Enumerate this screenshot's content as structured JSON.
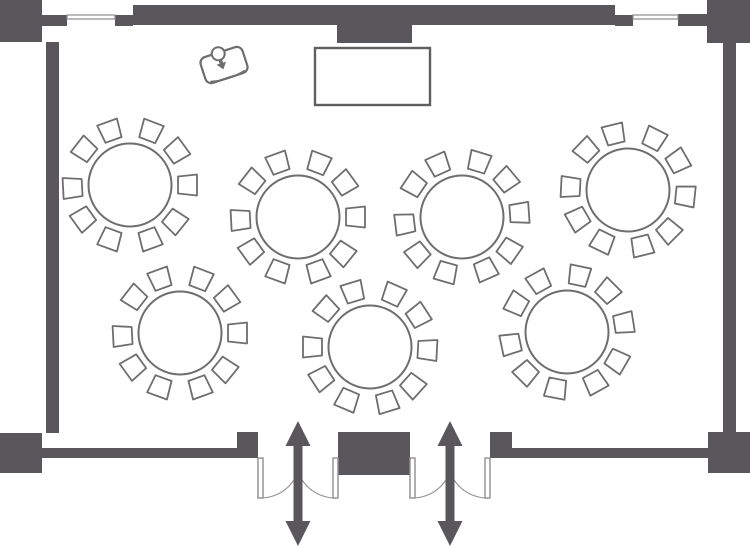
{
  "canvas": {
    "width": 750,
    "height": 547
  },
  "colors": {
    "background": "#ffffff",
    "wall": "#5a575c",
    "furniture_outline": "#6e6e6e",
    "furniture_fill": "#ffffff",
    "window_frame": "#8c8c8c",
    "door_leaf_stroke": "#8f8f8f",
    "door_arc": "#9a9a9a",
    "arrow": "#5a575c"
  },
  "room": {
    "walls": [
      {
        "name": "corner-top-left",
        "x": 0,
        "y": 0,
        "w": 42,
        "h": 42
      },
      {
        "name": "wall-top-left-tab",
        "x": 42,
        "y": 15,
        "w": 25,
        "h": 11
      },
      {
        "name": "wall-top-window-stub-left",
        "x": 115,
        "y": 15,
        "w": 18,
        "h": 11
      },
      {
        "name": "wall-top-main",
        "x": 133,
        "y": 5,
        "w": 482,
        "h": 20
      },
      {
        "name": "wall-top-pillar",
        "x": 337,
        "y": 25,
        "w": 75,
        "h": 18
      },
      {
        "name": "wall-top-window-stub-right",
        "x": 615,
        "y": 15,
        "w": 18,
        "h": 11
      },
      {
        "name": "wall-top-right-tab",
        "x": 678,
        "y": 14,
        "w": 29,
        "h": 12
      },
      {
        "name": "corner-top-right",
        "x": 707,
        "y": 0,
        "w": 43,
        "h": 43
      },
      {
        "name": "wall-left",
        "x": 46,
        "y": 42,
        "w": 13,
        "h": 391
      },
      {
        "name": "wall-right",
        "x": 723,
        "y": 43,
        "w": 13,
        "h": 389
      },
      {
        "name": "corner-bottom-left",
        "x": 0,
        "y": 433,
        "w": 42,
        "h": 40
      },
      {
        "name": "wall-bottom-left",
        "x": 42,
        "y": 448,
        "w": 195,
        "h": 10
      },
      {
        "name": "door-jamb-pillar-left",
        "x": 237,
        "y": 432,
        "w": 21,
        "h": 26
      },
      {
        "name": "wall-bottom-center-block",
        "x": 338,
        "y": 432,
        "w": 72,
        "h": 43
      },
      {
        "name": "door-jamb-pillar-right",
        "x": 490,
        "y": 432,
        "w": 22,
        "h": 26
      },
      {
        "name": "wall-bottom-right",
        "x": 512,
        "y": 448,
        "w": 196,
        "h": 10
      },
      {
        "name": "corner-bottom-right",
        "x": 708,
        "y": 432,
        "w": 42,
        "h": 41
      }
    ],
    "windows": [
      {
        "name": "window-top-left",
        "x": 67,
        "y": 15,
        "w": 48,
        "h": 4
      },
      {
        "name": "window-top-right",
        "x": 633,
        "y": 15,
        "w": 45,
        "h": 4
      }
    ]
  },
  "stage": {
    "name": "head-table",
    "x": 315,
    "y": 48,
    "w": 115,
    "h": 57
  },
  "lectern": {
    "name": "lectern",
    "cx": 224,
    "cy": 65,
    "rotation": -18,
    "body_w": 44,
    "body_h": 27,
    "head_r": 6.5
  },
  "tables": {
    "radius": 41.5,
    "chair": {
      "back_w": 21,
      "front_w": 17,
      "depth": 19,
      "ring_r": 57.5,
      "count": 10,
      "step_deg": 36,
      "jitter_deg": [
        0,
        3,
        -2,
        2,
        0,
        -3,
        2,
        -2,
        3,
        0
      ]
    },
    "items": [
      {
        "id": "banquet-table-1",
        "cx": 130,
        "cy": 185,
        "phase_deg": 0
      },
      {
        "id": "banquet-table-2",
        "cx": 298,
        "cy": 217,
        "phase_deg": 0
      },
      {
        "id": "banquet-table-3",
        "cx": 462,
        "cy": 217,
        "phase_deg": -4
      },
      {
        "id": "banquet-table-4",
        "cx": 628,
        "cy": 190,
        "phase_deg": 6
      },
      {
        "id": "banquet-table-5",
        "cx": 180,
        "cy": 333,
        "phase_deg": 0
      },
      {
        "id": "banquet-table-6",
        "cx": 370,
        "cy": 347,
        "phase_deg": 3
      },
      {
        "id": "banquet-table-7",
        "cx": 567,
        "cy": 332,
        "phase_deg": -9
      }
    ]
  },
  "doors": {
    "leaf_len": 40,
    "leaf_w": 5,
    "wall_y": 458,
    "items": [
      {
        "id": "double-door-left",
        "x1": 258,
        "x2": 338
      },
      {
        "id": "double-door-right",
        "x1": 410,
        "x2": 490
      }
    ]
  },
  "arrows": {
    "head_half_w": 12.5,
    "head_h": 25,
    "shaft_half_w": 4.5,
    "items": [
      {
        "id": "entrance-arrow-left",
        "x": 298,
        "y1": 421,
        "y2": 546
      },
      {
        "id": "entrance-arrow-right",
        "x": 450,
        "y1": 421,
        "y2": 546
      }
    ]
  }
}
